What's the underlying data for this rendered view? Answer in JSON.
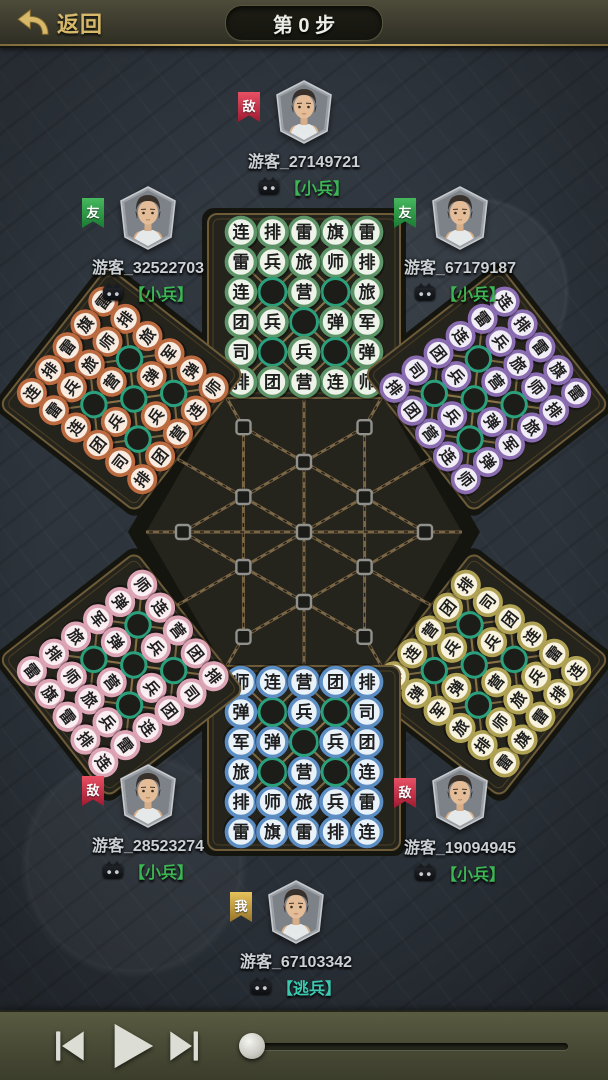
{
  "top_bar": {
    "back_label": "返回",
    "step_label": "第 0 步"
  },
  "players": {
    "top": {
      "name": "游客_27149721",
      "rank": "【小兵】",
      "badge": "敌",
      "badge_type": "enemy"
    },
    "upper_left": {
      "name": "游客_32522703",
      "rank": "【小兵】",
      "badge": "友",
      "badge_type": "ally"
    },
    "upper_right": {
      "name": "游客_67179187",
      "rank": "【小兵】",
      "badge": "友",
      "badge_type": "ally"
    },
    "lower_left": {
      "name": "游客_28523274",
      "rank": "【小兵】",
      "badge": "敌",
      "badge_type": "enemy"
    },
    "lower_right": {
      "name": "游客_19094945",
      "rank": "【小兵】",
      "badge": "敌",
      "badge_type": "enemy"
    },
    "bottom": {
      "name": "游客_67103342",
      "rank": "【逃兵】",
      "badge": "我",
      "badge_type": "self"
    }
  },
  "board": {
    "step": 0,
    "setup_rows_outer_to_inner": [
      [
        "雷",
        "旗",
        "雷",
        "排",
        "连"
      ],
      [
        "排",
        "师",
        "旅",
        "兵",
        "雷"
      ],
      [
        "旅",
        "",
        "营",
        "",
        "连"
      ],
      [
        "军",
        "弹",
        "",
        "兵",
        "团"
      ],
      [
        "弹",
        "",
        "兵",
        "",
        "司"
      ],
      [
        "师",
        "连",
        "营",
        "团",
        "排"
      ]
    ],
    "camp_ring_color": "#2aa07c",
    "armies": [
      {
        "position": "north",
        "bearing": 0,
        "ring": "#5d9468",
        "rim": "#2e5c3a",
        "face": "#eef3ea"
      },
      {
        "position": "northeast",
        "bearing": 52,
        "ring": "#8a6cb0",
        "rim": "#4f3a70",
        "face": "#f1edf7"
      },
      {
        "position": "southeast",
        "bearing": 128,
        "ring": "#b0a254",
        "rim": "#6e6226",
        "face": "#f7f3df"
      },
      {
        "position": "south",
        "bearing": 180,
        "ring": "#5b8cc2",
        "rim": "#2c5580",
        "face": "#e9f1f9"
      },
      {
        "position": "southwest",
        "bearing": 232,
        "ring": "#dca4b4",
        "rim": "#9c5a70",
        "face": "#f9eef1"
      },
      {
        "position": "northwest",
        "bearing": 308,
        "ring": "#bc6a40",
        "rim": "#6e3518",
        "face": "#f8ece1"
      }
    ]
  },
  "controls": {
    "prev_icon": "skip-previous",
    "play_icon": "play",
    "next_icon": "skip-next",
    "progress_value": 0
  },
  "theme": {
    "accent-gold": "#d8b96a",
    "rank-green": "#3cb554",
    "rank-teal": "#3bc9b0",
    "name-color": "#ccd1d6",
    "badge-enemy": "#a01a30",
    "badge-ally": "#1b7a33",
    "badge-self": "#96742a",
    "board-panel": "#24231c",
    "board-trim": "#6d5b38",
    "board-line": "#8a7347"
  }
}
